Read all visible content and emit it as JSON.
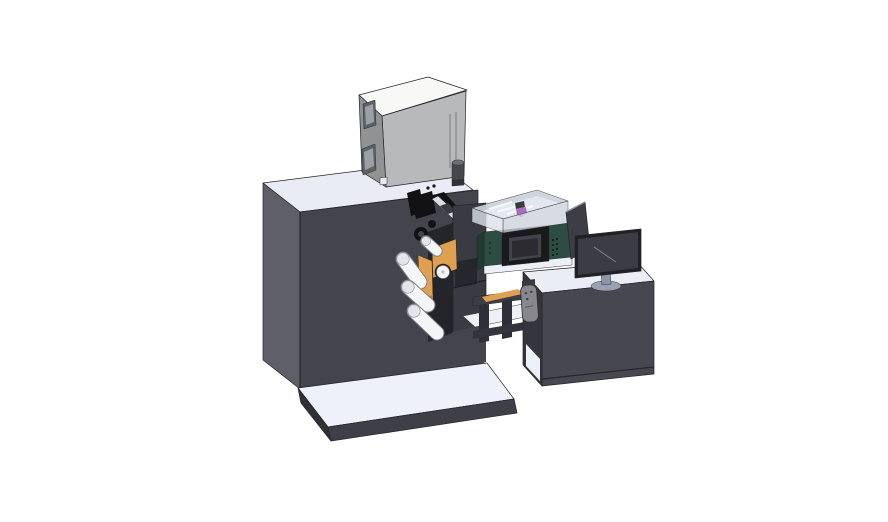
{
  "scene": {
    "width": 888,
    "height": 522,
    "type": "3d-cad-render",
    "subject": "label-printing-machine-with-operator-desk"
  },
  "colors": {
    "background": "#ffffff",
    "outline": "#24252a",
    "machine_front": "#43444c",
    "machine_side": "#5f5f6a",
    "machine_top": "#e9ecf5",
    "platform_top": "#eef1f9",
    "platform_side": "#3e3f47",
    "platform_end": "#2f3038",
    "box_front": "#b7b9bb",
    "box_side": "#909294",
    "box_top": "#f8f8f6",
    "box_window_frame": "#5f6163",
    "box_window_pane": "#9ba1a8",
    "cylinder_body": "#46474b",
    "cylinder_top": "#6d6e73",
    "mech_black": "#121214",
    "mech_gray": "#3a3b3f",
    "rail_silver": "#dcdee1",
    "backdrop_dark": "#24252a",
    "plate_dark": "#393a42",
    "plate_notch": "#26272c",
    "orange": "#dfa050",
    "orange_dark": "#b97c34",
    "roller_white": "#f4f5f7",
    "roller_edge": "#7c7f88",
    "roller_cap": "#e2e5ea",
    "green_unit": "#2e4c42",
    "green_dark": "#213a32",
    "hmi_bezel": "#1a1a1d",
    "hmi_screen": "#43434b",
    "hmi_inner": "#2b2b31",
    "cover_wall": "#ccd2db",
    "cover_floor": "#e3e7ee",
    "cover_left": "#dde1e8",
    "purple": "#a86fc4",
    "magenta": "#c45ab4",
    "panel_dark": "#3c3d45",
    "desk_top": "#eaedf6",
    "desk_front": "#46474f",
    "desk_side": "#35363d",
    "shelf_white": "#eef0f8",
    "monitor_bezel": "#202125",
    "monitor_screen": "#3b3c44",
    "monitor_stand": "#9aa1b0",
    "pendant_body": "#87878d",
    "pendant_dark": "#3a3a40",
    "beam_dark": "#3c3d45",
    "leg_dark": "#2f3037"
  },
  "parts": [
    {
      "id": "main-machine-cabinet",
      "color": "machine_front"
    },
    {
      "id": "electronics-cabinet",
      "color": "box_front"
    },
    {
      "id": "exhaust-cylinder",
      "color": "cylinder_body"
    },
    {
      "id": "print-head-assembly",
      "color": "mech_black"
    },
    {
      "id": "guide-rail",
      "color": "rail_silver"
    },
    {
      "id": "roller-plate",
      "color": "plate_dark"
    },
    {
      "id": "web-guide-plates",
      "color": "orange"
    },
    {
      "id": "idler-rollers",
      "color": "roller_white"
    },
    {
      "id": "conveyor-bridge",
      "color": "beam_dark"
    },
    {
      "id": "control-unit",
      "color": "green_unit"
    },
    {
      "id": "hmi-display",
      "color": "hmi_screen"
    },
    {
      "id": "transparent-cover",
      "color": "cover_wall"
    },
    {
      "id": "side-panel",
      "color": "panel_dark"
    },
    {
      "id": "operator-desk",
      "color": "desk_front"
    },
    {
      "id": "monitor",
      "color": "monitor_bezel"
    },
    {
      "id": "hand-pendant",
      "color": "pendant_body"
    },
    {
      "id": "base-platform",
      "color": "platform_top"
    }
  ]
}
